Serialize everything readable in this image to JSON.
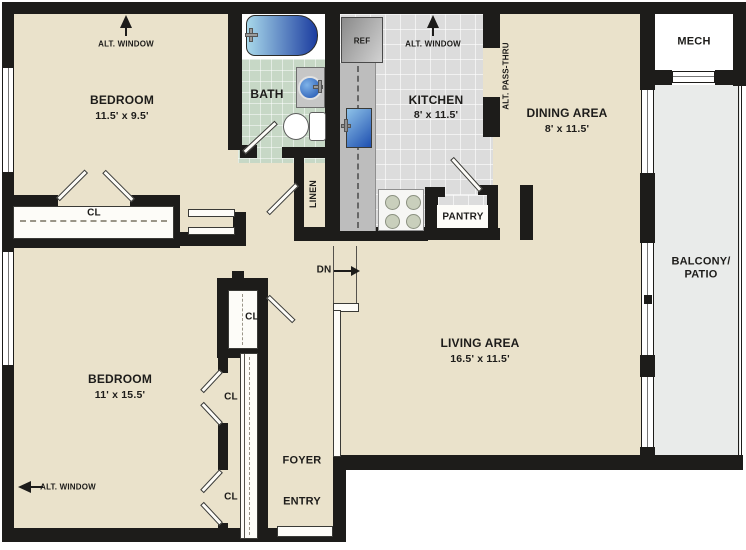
{
  "colors": {
    "wall": "#1d1c1a",
    "ink": "#1d1c1a",
    "floor": "#eae2cb",
    "ktile": "#dcdcdc",
    "btile": "#c7d8c6",
    "balc": "#e9ebea",
    "burner": "#c9cfbc",
    "tub_light": "#a8d8ea",
    "tub_dark": "#1c3da0",
    "sink_blue": "#1c4fae"
  },
  "rooms": {
    "bedroom1": {
      "name": "BEDROOM",
      "dims": "11.5' x 9.5'"
    },
    "bedroom2": {
      "name": "BEDROOM",
      "dims": "11' x 15.5'"
    },
    "kitchen": {
      "name": "KITCHEN",
      "dims": "8' x 11.5'"
    },
    "dining": {
      "name": "DINING AREA",
      "dims": "8' x 11.5'"
    },
    "living": {
      "name": "LIVING AREA",
      "dims": "16.5' x 11.5'"
    },
    "bath": {
      "name": "BATH"
    },
    "balcony": {
      "line1": "BALCONY/",
      "line2": "PATIO"
    },
    "mech": {
      "name": "MECH"
    },
    "foyer": {
      "name": "FOYER"
    },
    "entry": {
      "name": "ENTRY"
    },
    "pantry": {
      "name": "PANTRY"
    },
    "linen": {
      "name": "LINEN"
    }
  },
  "labels": {
    "alt_window": "ALT. WINDOW",
    "alt_pass_thru": "ALT. PASS-THRU",
    "ref": "REF",
    "closet": "CL",
    "down": "DN"
  }
}
